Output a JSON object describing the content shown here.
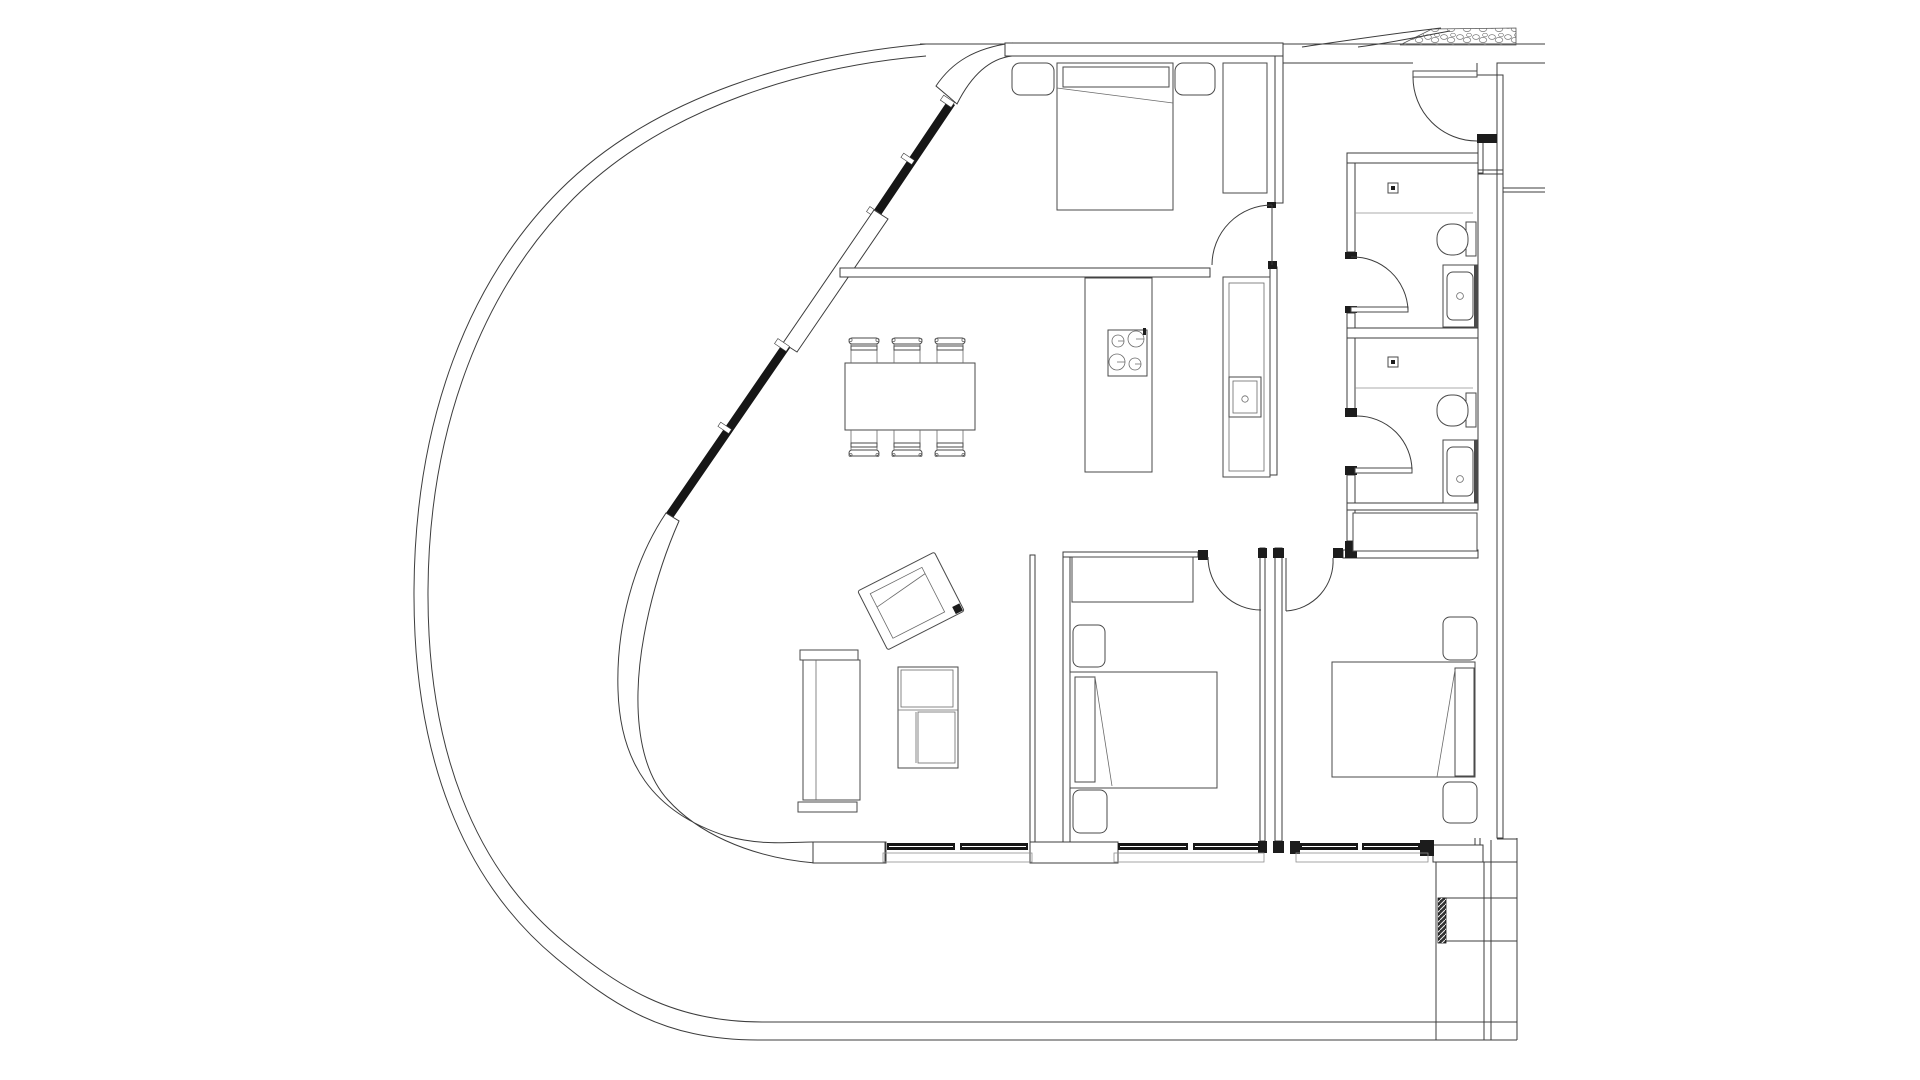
{
  "meta": {
    "title": "Apartment floor plan drawing",
    "drawing_type": "architectural plan, black line work on white",
    "visible_text": "none"
  },
  "palette": {
    "background": "#ffffff",
    "ink": "#3c3c3c",
    "glazing_black": "#161616",
    "jamb_black": "#1c1c1c",
    "light_gray": "#8f8f8f"
  },
  "site": {
    "terrace_edge": "large rounded curve sweeping from top centre to bottom, double line",
    "landscape_hatch": "stone/pebble hatch strip at top right",
    "exterior_steps": "stepped slab lines at bottom right"
  },
  "rooms": [
    {
      "name": "bedroom-1",
      "position": "top centre",
      "furniture": [
        "double-bed",
        "nightstand-left",
        "nightstand-right",
        "wardrobe"
      ]
    },
    {
      "name": "kitchen-dining",
      "position": "centre",
      "furniture": [
        "dining-table",
        "six-chairs",
        "cooktop-peninsula",
        "sink-counter"
      ]
    },
    {
      "name": "living-area",
      "position": "lower left",
      "furniture": [
        "sofa",
        "armchair",
        "shelf-unit"
      ]
    },
    {
      "name": "bedroom-2",
      "position": "bottom centre",
      "furniture": [
        "double-bed",
        "dresser",
        "nightstand-top",
        "nightstand-bottom"
      ]
    },
    {
      "name": "bedroom-3",
      "position": "bottom right",
      "furniture": [
        "double-bed",
        "nightstand-top",
        "nightstand-bottom"
      ]
    },
    {
      "name": "bathroom-1",
      "position": "upper right",
      "fixtures": [
        "shower-drain",
        "toilet",
        "vanity-sink"
      ]
    },
    {
      "name": "bathroom-2",
      "position": "mid right",
      "fixtures": [
        "shower-drain",
        "toilet",
        "vanity-sink"
      ]
    },
    {
      "name": "hallway-vestibule",
      "position": "right",
      "features": [
        "entry-door",
        "closet"
      ]
    }
  ],
  "doors": [
    "entry-door-top-right",
    "bedroom-1-door",
    "bedroom-2-door",
    "bedroom-3-door",
    "bathroom-1-door",
    "bathroom-2-door"
  ],
  "windows": [
    "diagonal-curtain-wall-two-panels",
    "bottom-window-living",
    "bottom-window-bedroom-2",
    "bottom-window-bedroom-3"
  ]
}
